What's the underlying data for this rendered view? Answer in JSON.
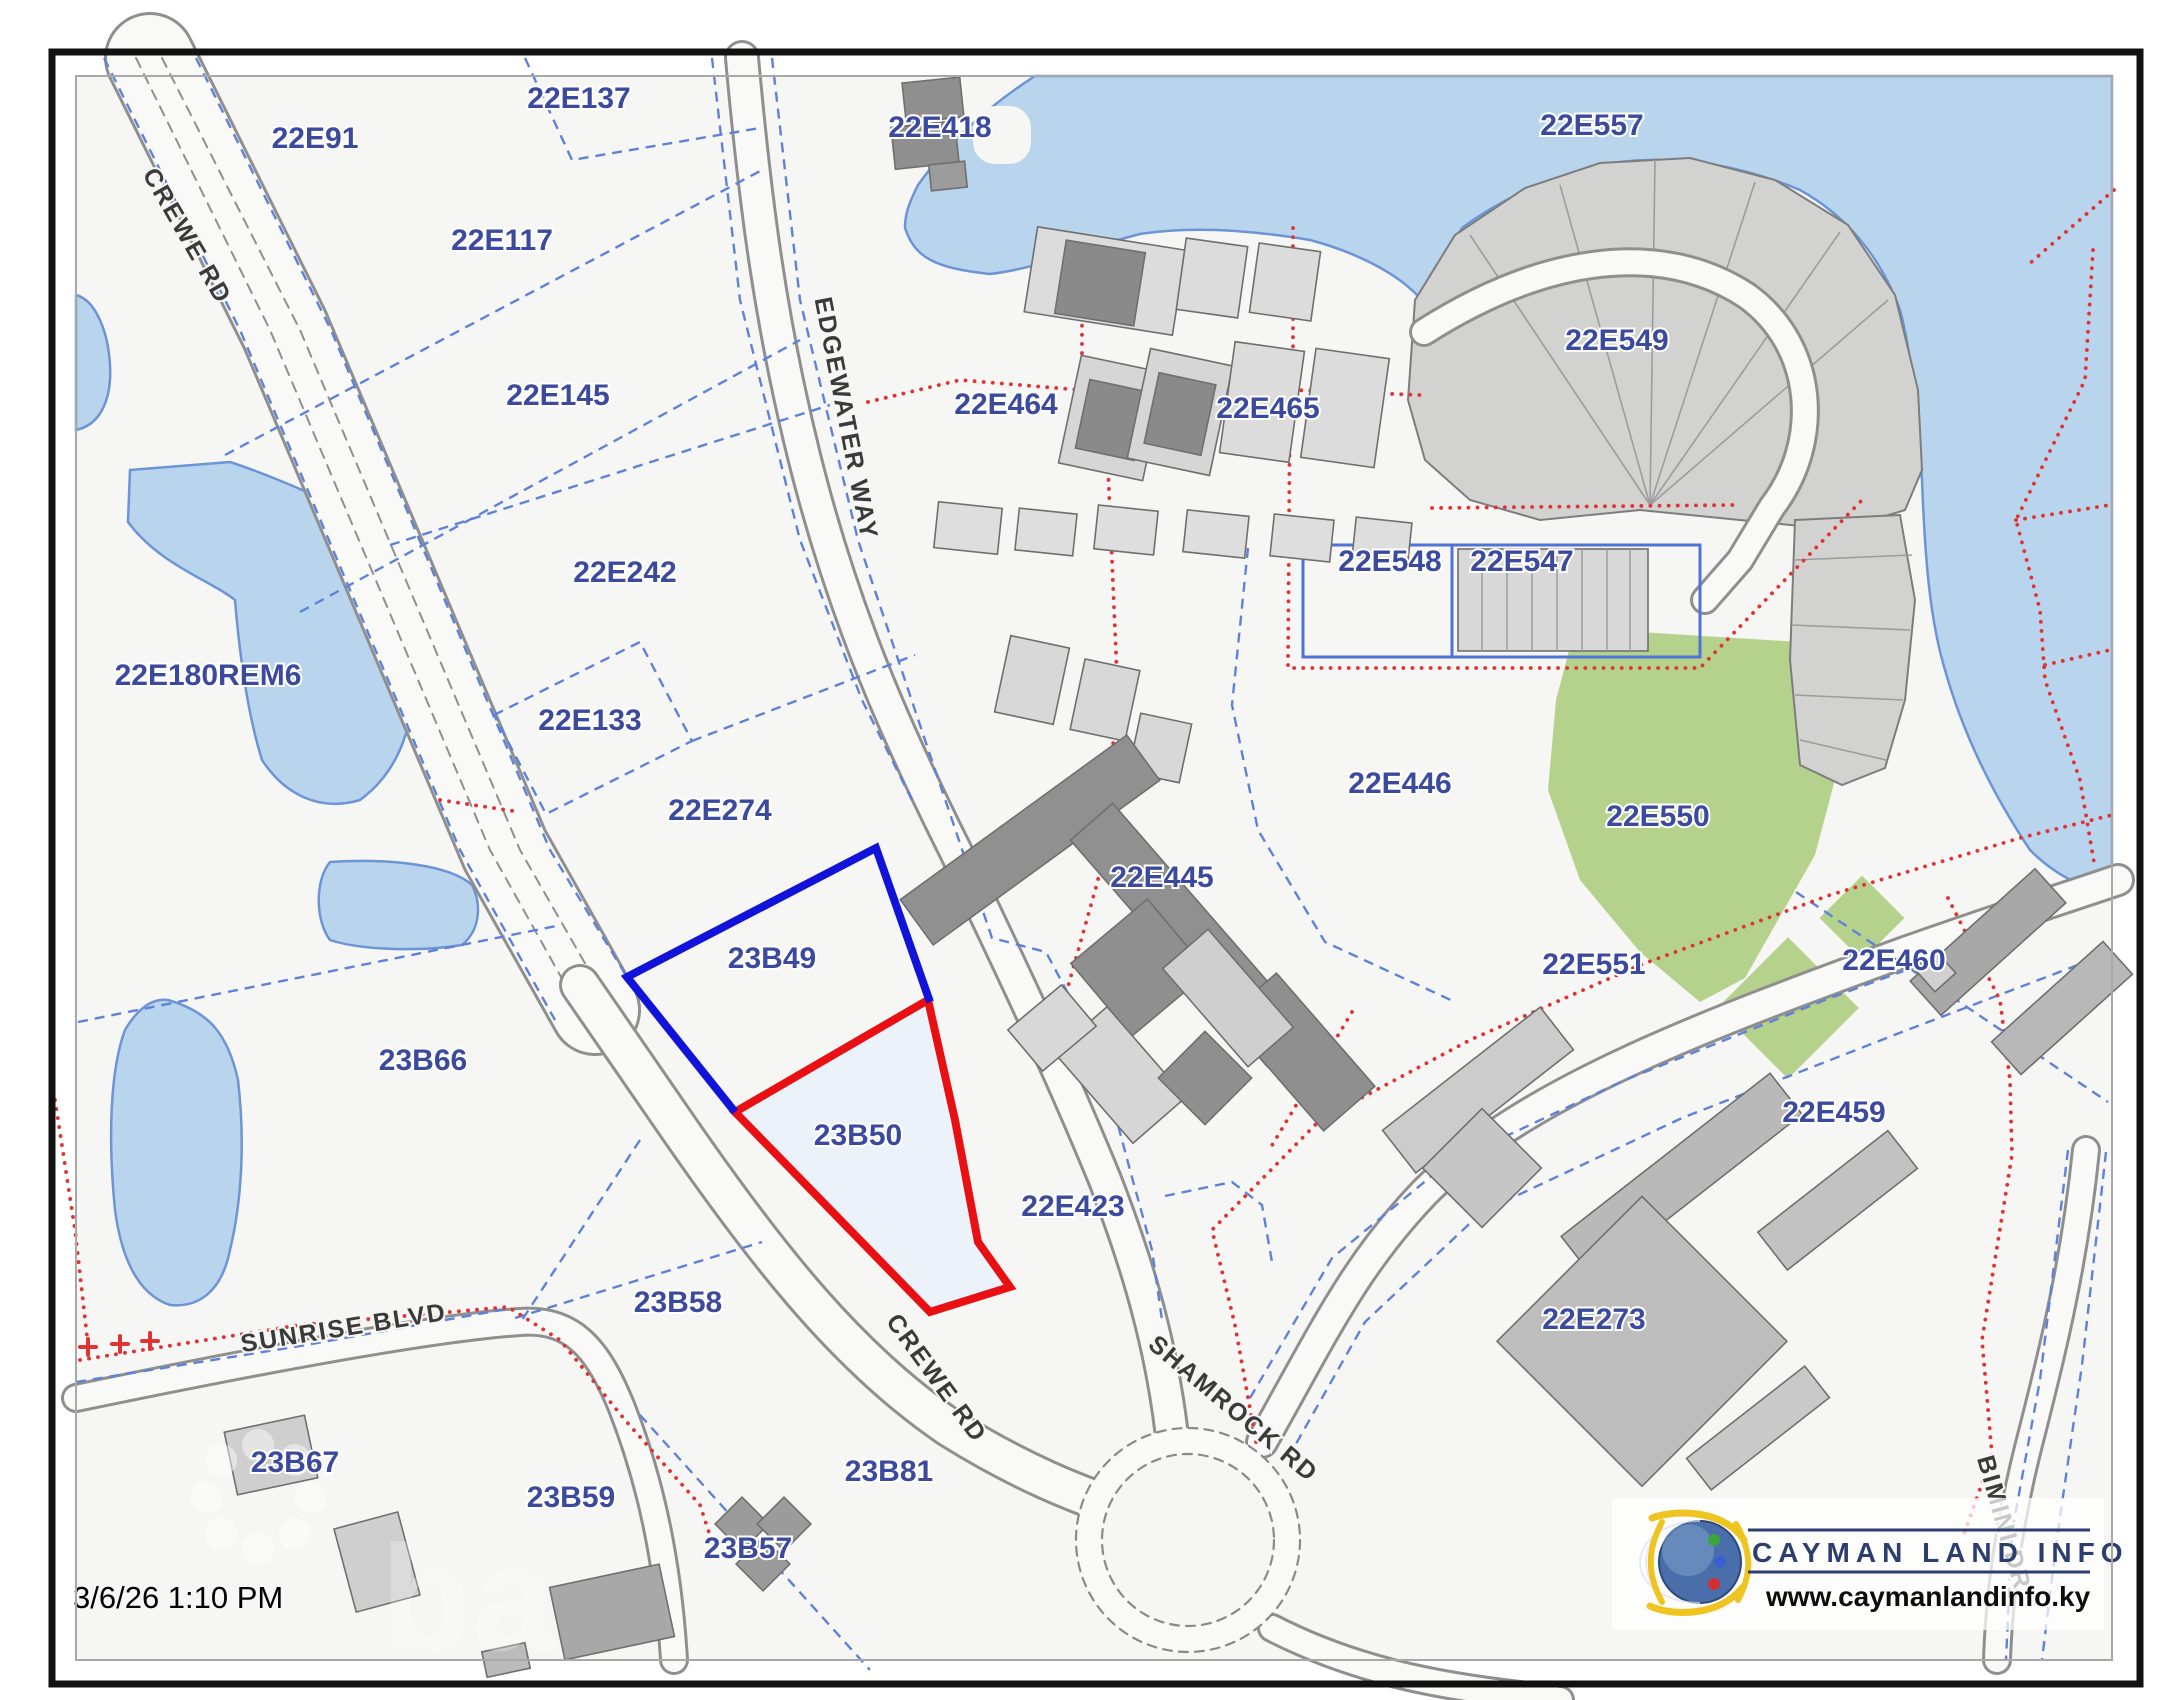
{
  "map": {
    "timestamp": "3/6/26 1:10 PM",
    "highlight": {
      "selected_parcel": "23B50",
      "selected_color": "#e81013",
      "adjacent_parcel": "23B49",
      "adjacent_color": "#1113d8"
    },
    "labels": [
      {
        "text": "22E91",
        "x": 315,
        "y": 148,
        "rot": 0,
        "type": "parcel"
      },
      {
        "text": "22E137",
        "x": 579,
        "y": 108,
        "rot": 0,
        "type": "parcel"
      },
      {
        "text": "22E117",
        "x": 502,
        "y": 250,
        "rot": 0,
        "type": "parcel"
      },
      {
        "text": "22E145",
        "x": 558,
        "y": 405,
        "rot": 0,
        "type": "parcel"
      },
      {
        "text": "22E242",
        "x": 625,
        "y": 582,
        "rot": 0,
        "type": "parcel"
      },
      {
        "text": "22E133",
        "x": 590,
        "y": 730,
        "rot": 0,
        "type": "parcel"
      },
      {
        "text": "22E274",
        "x": 720,
        "y": 820,
        "rot": 0,
        "type": "parcel"
      },
      {
        "text": "22E180REM6",
        "x": 208,
        "y": 685,
        "rot": 0,
        "type": "parcel"
      },
      {
        "text": "23B49",
        "x": 772,
        "y": 968,
        "rot": 0,
        "type": "parcel"
      },
      {
        "text": "23B50",
        "x": 858,
        "y": 1145,
        "rot": 0,
        "type": "parcel"
      },
      {
        "text": "23B66",
        "x": 423,
        "y": 1070,
        "rot": 0,
        "type": "parcel"
      },
      {
        "text": "23B58",
        "x": 678,
        "y": 1312,
        "rot": 0,
        "type": "parcel"
      },
      {
        "text": "23B67",
        "x": 295,
        "y": 1472,
        "rot": 0,
        "type": "parcel"
      },
      {
        "text": "23B59",
        "x": 571,
        "y": 1507,
        "rot": 0,
        "type": "parcel"
      },
      {
        "text": "23B81",
        "x": 889,
        "y": 1481,
        "rot": 0,
        "type": "parcel"
      },
      {
        "text": "23B57",
        "x": 748,
        "y": 1558,
        "rot": 0,
        "type": "parcel"
      },
      {
        "text": "22E418",
        "x": 940,
        "y": 137,
        "rot": 0,
        "type": "parcel"
      },
      {
        "text": "22E464",
        "x": 1006,
        "y": 414,
        "rot": 0,
        "type": "parcel"
      },
      {
        "text": "22E465",
        "x": 1268,
        "y": 418,
        "rot": 0,
        "type": "parcel"
      },
      {
        "text": "22E548",
        "x": 1390,
        "y": 571,
        "rot": 0,
        "type": "parcel"
      },
      {
        "text": "22E547",
        "x": 1522,
        "y": 571,
        "rot": 0,
        "type": "parcel"
      },
      {
        "text": "22E557",
        "x": 1592,
        "y": 135,
        "rot": 0,
        "type": "parcel"
      },
      {
        "text": "22E549",
        "x": 1617,
        "y": 350,
        "rot": 0,
        "type": "parcel"
      },
      {
        "text": "22E446",
        "x": 1400,
        "y": 793,
        "rot": 0,
        "type": "parcel"
      },
      {
        "text": "22E550",
        "x": 1658,
        "y": 826,
        "rot": 0,
        "type": "parcel"
      },
      {
        "text": "22E445",
        "x": 1162,
        "y": 887,
        "rot": 0,
        "type": "parcel"
      },
      {
        "text": "22E551",
        "x": 1594,
        "y": 974,
        "rot": 0,
        "type": "parcel"
      },
      {
        "text": "22E460",
        "x": 1894,
        "y": 970,
        "rot": 0,
        "type": "parcel"
      },
      {
        "text": "22E459",
        "x": 1834,
        "y": 1122,
        "rot": 0,
        "type": "parcel"
      },
      {
        "text": "22E423",
        "x": 1073,
        "y": 1216,
        "rot": 0,
        "type": "parcel"
      },
      {
        "text": "22E273",
        "x": 1594,
        "y": 1329,
        "rot": 0,
        "type": "parcel"
      },
      {
        "text": "CREWE RD",
        "x": 180,
        "y": 240,
        "rot": 60,
        "type": "road"
      },
      {
        "text": "CREWE RD",
        "x": 930,
        "y": 1383,
        "rot": 54,
        "type": "road"
      },
      {
        "text": "EDGEWATER WAY",
        "x": 838,
        "y": 420,
        "rot": 79,
        "type": "road"
      },
      {
        "text": "SUNRISE BLVD",
        "x": 345,
        "y": 1336,
        "rot": -9,
        "type": "road"
      },
      {
        "text": "SHAMROCK RD",
        "x": 1228,
        "y": 1415,
        "rot": 40,
        "type": "road"
      },
      {
        "text": "BIMINI DR",
        "x": 1996,
        "y": 1525,
        "rot": 74,
        "type": "road"
      }
    ]
  },
  "branding": {
    "name": "CAYMAN LAND INFO",
    "url": "www.caymanlandinfo.ky"
  },
  "colors": {
    "water": "#b9d5ed",
    "water_edge": "#6d94d4",
    "vegetation": "#b5d28c",
    "parcel_line": "#5f82d8",
    "boundary_red": "#e03434",
    "label_navy": "#3c4a9e",
    "building_gray": "#ababab",
    "selected_red": "#e81013",
    "adjacent_blue": "#1113d8"
  }
}
